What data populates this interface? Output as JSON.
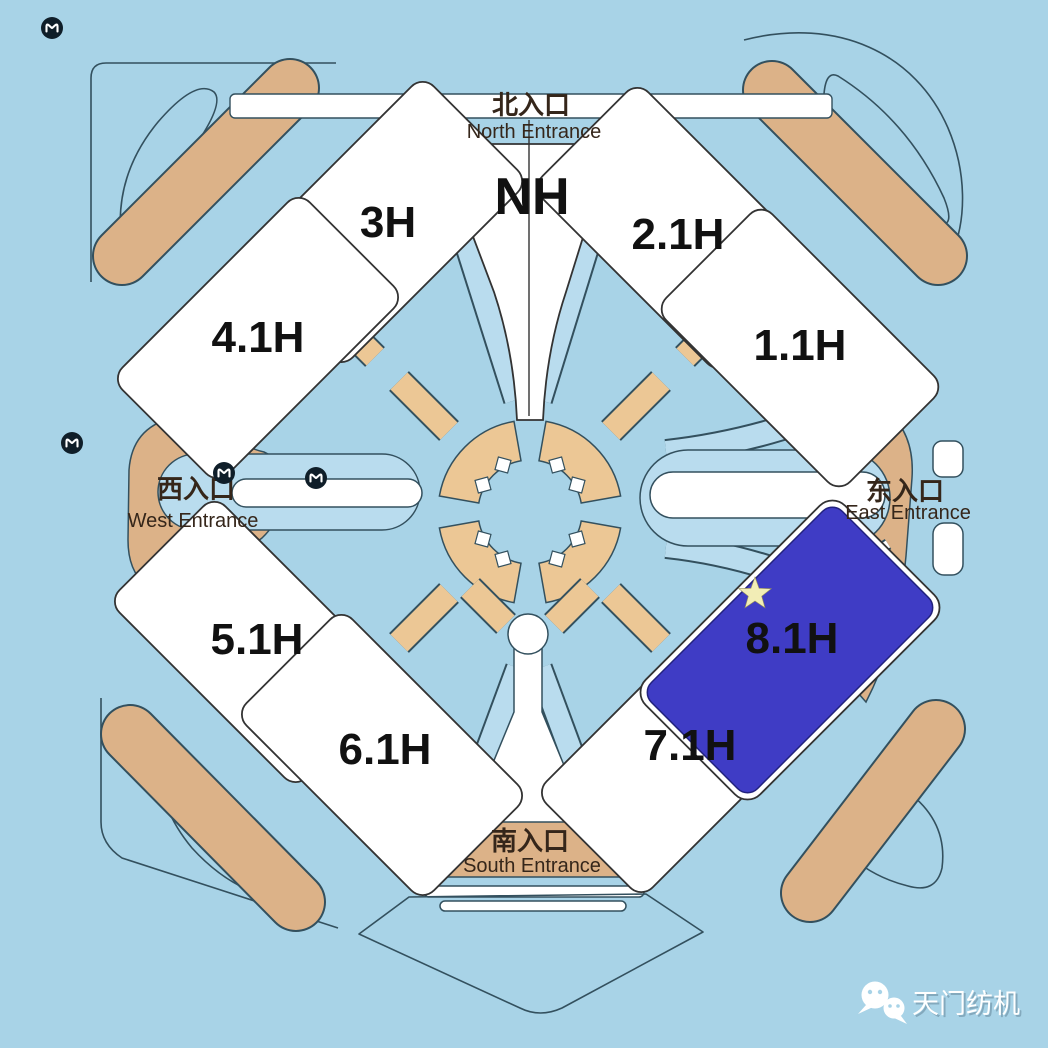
{
  "colors": {
    "bg": "#a8d3e7",
    "band": "#b9dcee",
    "road": "#33505e",
    "tan": "#dcb288",
    "tan-light": "#ecc795",
    "highlight": "#3f3cc5",
    "hall-outline": "#333333",
    "star": "#f2edb6",
    "ink": "#111111",
    "entrance-ink": "#35261a",
    "watermark-ink": "#ffffff"
  },
  "halls": [
    {
      "id": "3H",
      "label": "3H",
      "highlighted": false
    },
    {
      "id": "NH",
      "label": "NH",
      "highlighted": false
    },
    {
      "id": "2.1H",
      "label": "2.1H",
      "highlighted": false
    },
    {
      "id": "4.1H",
      "label": "4.1H",
      "highlighted": false
    },
    {
      "id": "1.1H",
      "label": "1.1H",
      "highlighted": false
    },
    {
      "id": "5.1H",
      "label": "5.1H",
      "highlighted": false
    },
    {
      "id": "6.1H",
      "label": "6.1H",
      "highlighted": false
    },
    {
      "id": "7.1H",
      "label": "7.1H",
      "highlighted": false
    },
    {
      "id": "8.1H",
      "label": "8.1H",
      "highlighted": true,
      "marker": "star"
    }
  ],
  "entrances": {
    "north": {
      "zh": "北入口",
      "en": "North Entrance"
    },
    "west": {
      "zh": "西入口",
      "en": "West Entrance"
    },
    "east": {
      "zh": "东入口",
      "en": "East Entrance"
    },
    "south": {
      "zh": "南入口",
      "en": "South Entrance"
    }
  },
  "icons": {
    "metro": "metro-icon",
    "star": "star-marker",
    "wechat": "wechat-icon"
  },
  "watermark": {
    "text": "天门纺机"
  }
}
